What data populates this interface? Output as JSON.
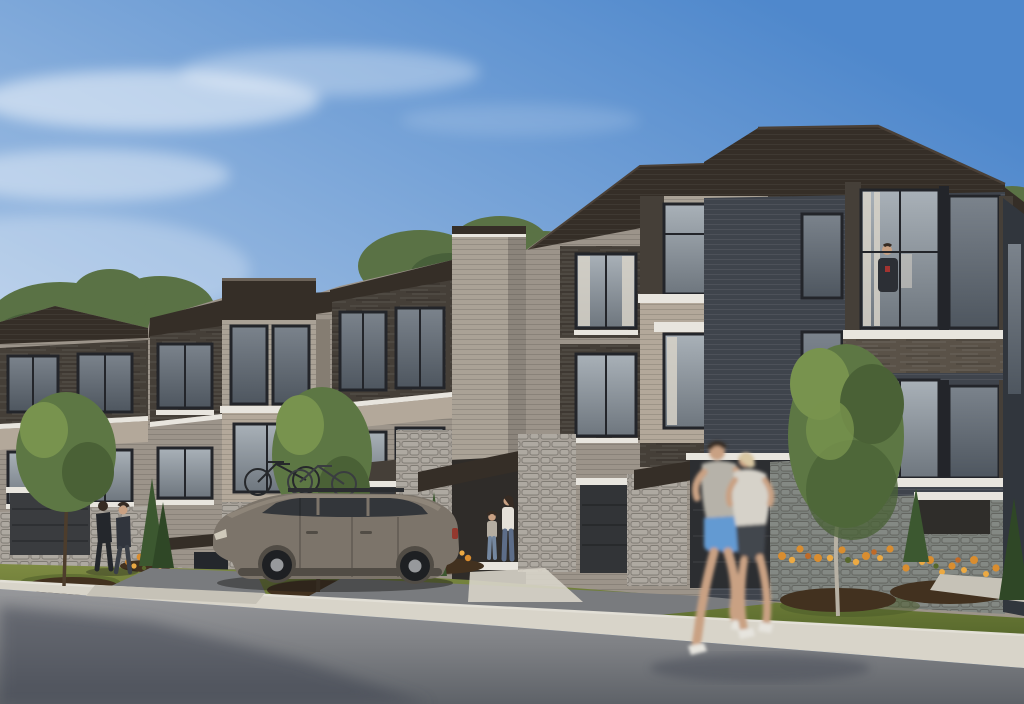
{
  "image": {
    "width": 1024,
    "height": 704,
    "kind": "exterior architectural rendering",
    "text_content": "none"
  },
  "scene": {
    "subject": "row of modern three-storey townhomes along a suburban street, viewed from the street corner",
    "sky": "clear blue sky, paler toward the left with thin white clouds",
    "architecture": [
      "dark charcoal hip roofs",
      "grey and beige brick facades",
      "dark horizontal wood-grain siding panels",
      "stacked-stone ground-floor piers",
      "black-framed windows with white sills and lintels",
      "dark garage doors",
      "black metal entry canopies",
      "flat-topped parapet bay and tall brick stair tower"
    ],
    "foreground": [
      "asphalt road with shadow at lower left",
      "white curb and concrete sidewalk",
      "front lawns",
      "orange flower beds on dark mulch",
      "young deciduous street trees",
      "columnar evergreen shrubs"
    ],
    "people": [
      "couple walking near the left driveway",
      "woman and child at a front entrance",
      "resident standing at the upper corner window",
      "motion-blurred man and woman jogging across the foreground"
    ],
    "vehicle": "grey-bronze station wagon parked in a driveway with two bicycles on its roof rack"
  },
  "palette": {
    "sky_top": "#4f88cc",
    "sky_mid": "#96b8e0",
    "sky_low": "#d8e3f2",
    "cloud": "#f0f5fb",
    "treeline": "#5a7245",
    "treeline_dk": "#48603a",
    "roof": "#352e27",
    "roof_hi": "#4a4037",
    "fascia": "#dcd8cf",
    "parapet_line": "#6b6258",
    "brick_grey": "#9c948a",
    "brick_grey_lt": "#aaa296",
    "brick_grey_sh": "#857d72",
    "brick_beige": "#b3a89a",
    "wood_dark": "#453f38",
    "wood_mid": "#5a5248",
    "brick_blue": "#3f444c",
    "brick_blue_dk": "#31363d",
    "stone": "#a8a29a",
    "stone_blue": "#7b807b",
    "trim_white": "#e8e5de",
    "win_frame": "#23252a",
    "glass_top": "#a9b1b8",
    "glass_bot": "#6e767e",
    "glass_d_top": "#7b838c",
    "glass_d_bot": "#4e565f",
    "curtain": "#d7d2c8",
    "int_warm": "#e6d7ac",
    "garage_a": "#3a3c3f",
    "garage_c": "#35373a",
    "garage_d": "#323437",
    "garage_e": "#2c2e31",
    "grass_lt": "#7e8b42",
    "grass": "#6a7936",
    "grass_dk": "#57682c",
    "mulch": "#42311f",
    "flower_orange": "#d98d2f",
    "flower_orange_lt": "#ecaa43",
    "flower_red": "#c06a28",
    "drive": "#797b7e",
    "apron": "#c6c2b7",
    "sidewalk": "#d8d4c9",
    "curb": "#e2dfd6",
    "road_lt": "#97989b",
    "road": "#7e8084",
    "road_dk": "#5e6268",
    "shadow": "#3c4250",
    "trunk": "#4d3d2c",
    "trunk_lt": "#b7b1a4",
    "tree_green": "#5d7744",
    "tree_green_lt": "#78934e",
    "tree_green_dk": "#4a6136",
    "evergreen": "#3c5830",
    "evergreen_dk": "#2f4726",
    "car_body": "#7c746a",
    "car_body_lt": "#968d80",
    "car_body_dk": "#514c45",
    "car_glass": "#33363a",
    "wheel": "#1e2023",
    "hub": "#97999c",
    "taillight": "#93392e",
    "headlight": "#cfc9ba",
    "skin": "#c9a183",
    "hair_dk": "#362b23",
    "hair_blonde": "#d8c7a3",
    "walker_dark": "#24272c",
    "walker_mid": "#31353d",
    "denim": "#5d6d88",
    "child_top": "#b5aea2",
    "jog_shirt": "#b6b2a9",
    "jog_shorts": "#649ad2",
    "jog_top_w": "#d6d2c9",
    "jog_capri": "#42464e",
    "shoe": "#e6e4de",
    "resident_shirt": "#2c2f35",
    "resident_accent": "#a23330"
  }
}
